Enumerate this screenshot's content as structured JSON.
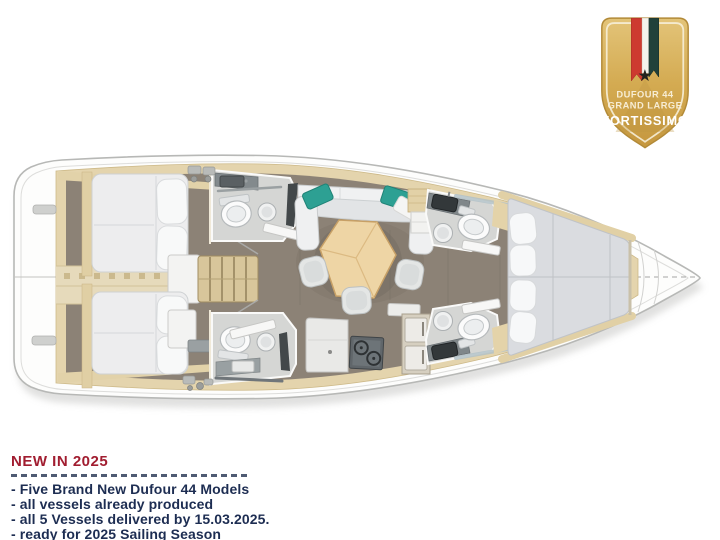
{
  "page": {
    "background_color": "#ffffff"
  },
  "badge": {
    "title_line1": "DUFOUR 44",
    "title_line2": "GRAND LARGE",
    "title_line3": "FORTISSIMO",
    "star_icon": "★",
    "colors": {
      "gold": "#d2a94f",
      "gold_border": "#b28a38",
      "ribbon_red": "#cd3a30",
      "ribbon_white": "#f4f2ec",
      "ribbon_green": "#21413a",
      "text_light": "#faf1dc",
      "text_white": "#ffffff"
    }
  },
  "announcement": {
    "title": "NEW IN 2025",
    "items": [
      "- Five Brand New Dufour 44 Models",
      "- all vessels already produced",
      "- all 5 Vessels delivered by 15.03.2025.",
      "- ready for 2025 Sailing Season"
    ],
    "colors": {
      "title": "#a11d30",
      "body": "#1d2d52",
      "rule": "#4f5b73"
    }
  },
  "deck_plan": {
    "subject": "Dufour 44 interior deck plan, top view, bow to the right",
    "colors": {
      "hull": "#fdfdfc",
      "hull_outline": "#b7b8b6",
      "joinery_beige": "#e4d4ad",
      "cabin_sole": "#8c8276",
      "mattress_white": "#ededee",
      "cushion_teal": "#2da093",
      "table_wood": "#eed5a5",
      "stove_gray": "#60666a",
      "bath_floor": "#d5d6d4"
    }
  }
}
